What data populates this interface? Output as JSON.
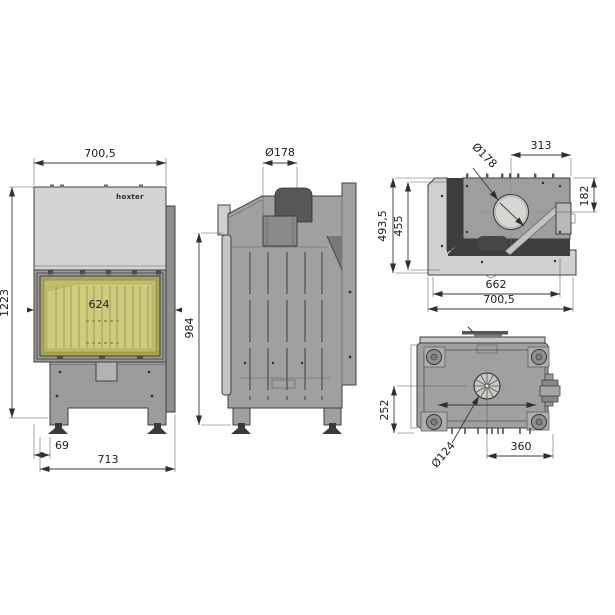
{
  "drawing": {
    "type": "technical-drawing",
    "subject": "fireplace insert, 4 orthographic views",
    "brand_logo": "hoxter",
    "colors": {
      "body_gray": "#a2a2a2",
      "panel_light": "#d4d4d4",
      "glass_yellow": "#c2bd6b",
      "dark_part": "#4f4f4f",
      "line": "#3a3a3a"
    },
    "views": {
      "front": {
        "label": "front view",
        "dims": {
          "width_top": "700,5",
          "height_total": "1223",
          "glass_width": "624",
          "leg_offset": "69",
          "width_bottom": "713"
        }
      },
      "side": {
        "label": "side view",
        "dims": {
          "flue_diameter": "Ø178",
          "height": "984"
        }
      },
      "top": {
        "label": "top view",
        "dims": {
          "flue_diameter": "Ø178",
          "flue_center_to_right": "313",
          "flue_center_to_back": "182",
          "depth_inner": "455",
          "depth_total": "493,5",
          "width_inner": "662",
          "width_total": "700,5"
        }
      },
      "bottom": {
        "label": "bottom view",
        "dims": {
          "base_height": "252",
          "fan_diameter": "Ø124",
          "fan_center_to_right": "360"
        }
      }
    }
  }
}
